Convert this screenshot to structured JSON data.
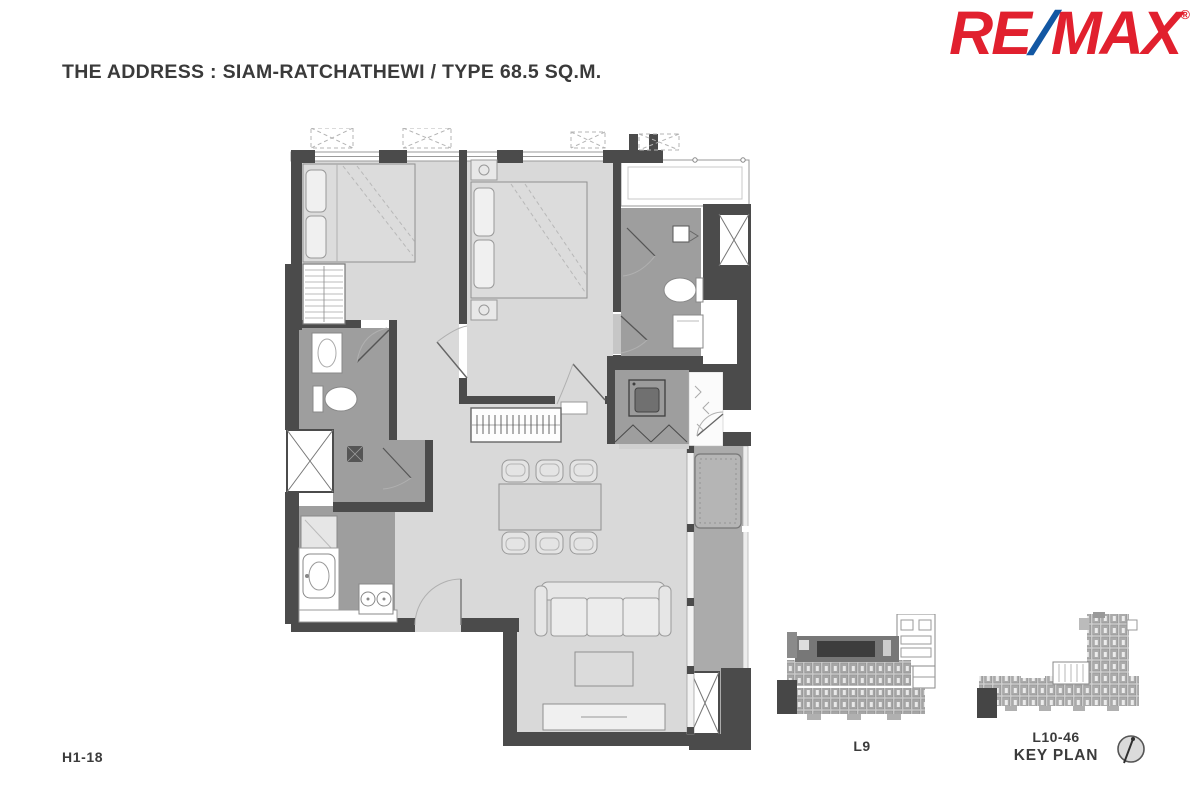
{
  "header": {
    "title": "THE ADDRESS : SIAM-RATCHATHEWI / TYPE 68.5 SQ.M."
  },
  "logo": {
    "re": "RE",
    "slash": "/",
    "max": "MAX",
    "registered": "®",
    "red": "#e1202e",
    "blue": "#1257a3"
  },
  "floor_plan": {
    "unit_code": "H1-18",
    "rooms": [
      "bedroom-1",
      "bedroom-2",
      "bathroom-1",
      "bathroom-2",
      "shower-room",
      "kitchen",
      "living-dining",
      "utility-closet",
      "foyer",
      "balcony",
      "ac-ledge"
    ]
  },
  "key_plans": {
    "left": {
      "label": "L9"
    },
    "right": {
      "label_line1": "L10-46",
      "label_line2": "KEY PLAN"
    },
    "compass_icon": "compass-icon"
  },
  "colors": {
    "background": "#ffffff",
    "wall": "#4b4b4b",
    "floor_light": "#d9d9d9",
    "floor_wet": "#9e9e9e",
    "balcony": "#ababab",
    "text": "#3b3b3b"
  }
}
